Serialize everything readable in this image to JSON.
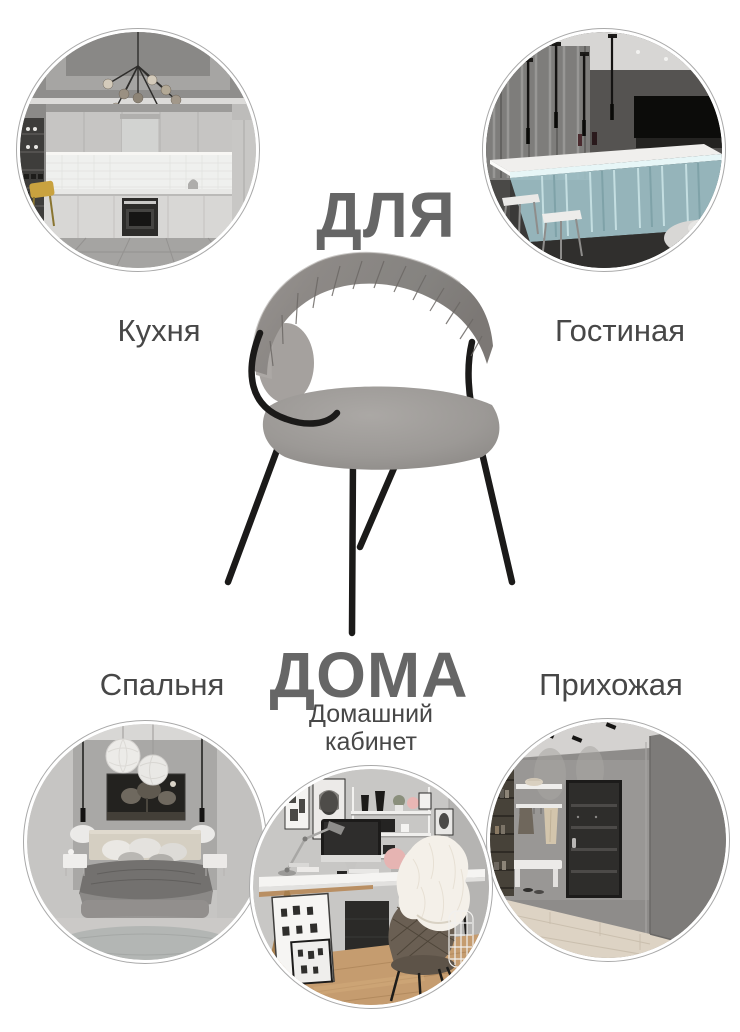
{
  "page": {
    "background": "#ffffff"
  },
  "headline": {
    "top": "ДЛЯ",
    "bottom": "ДОМА"
  },
  "rooms": {
    "kitchen": {
      "label": "Кухня",
      "image": "kitchen-interior-photo"
    },
    "living_room": {
      "label": "Гостиная",
      "image": "living-room-bar-interior-photo"
    },
    "bedroom": {
      "label": "Спальня",
      "image": "bedroom-interior-photo"
    },
    "home_office": {
      "label": "Домашний кабинет",
      "image": "home-office-interior-photo"
    },
    "hallway": {
      "label": "Прихожая",
      "image": "hallway-interior-photo"
    }
  },
  "product": {
    "image": "gray-upholstered-chair-product-photo"
  },
  "colors": {
    "page_bg": "#ffffff",
    "headline_color": "#666666",
    "label_color": "#474747",
    "ring_color": "#a9a9a9",
    "chair_fabric": "#878380",
    "chair_seat": "#9c9895",
    "chair_frame": "#1b1a19"
  }
}
